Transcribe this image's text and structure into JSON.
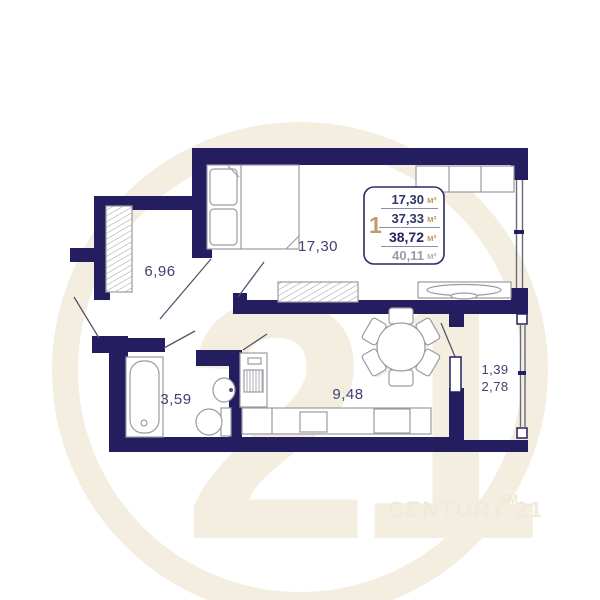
{
  "rooms": {
    "living": {
      "label": "17,30"
    },
    "hallway": {
      "label": "6,96"
    },
    "bathroom": {
      "label": "3,59"
    },
    "kitchen": {
      "label": "9,48"
    },
    "balcony": {
      "line1": "1,39",
      "line2": "2,78"
    }
  },
  "info_box": {
    "rooms_count": "1",
    "rows": [
      {
        "value": "17,30",
        "unit": "м²"
      },
      {
        "value": "37,33",
        "unit": "м²"
      },
      {
        "value": "38,72",
        "unit": "м²"
      },
      {
        "value": "40,11",
        "unit": "м²"
      }
    ]
  },
  "watermark": {
    "number": "21",
    "brand": "CENTURY 21",
    "trademark": "SM"
  },
  "colors": {
    "wall": "#241e60",
    "accent_tan": "#c49a68",
    "label_text": "#3f3f74",
    "muted_text": "#9b9ba3",
    "watermark_beige": "#f4eee1"
  }
}
